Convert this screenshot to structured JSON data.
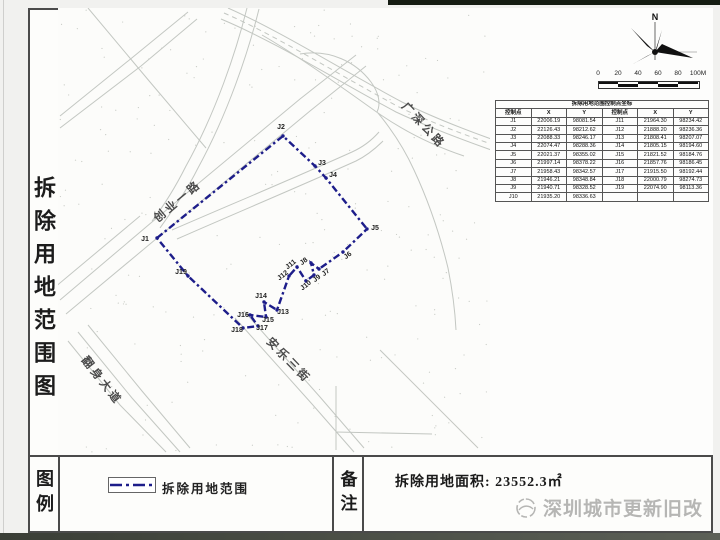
{
  "page": {
    "title_vertical": "拆除用地范围图"
  },
  "compass": {
    "label": "N"
  },
  "scale_bar": {
    "labels": [
      "0",
      "20",
      "40",
      "60",
      "80",
      "100M"
    ]
  },
  "coordinate_table": {
    "title": "拆除用地范围控制点坐标",
    "headers": [
      "控制点",
      "X",
      "Y",
      "控制点",
      "X",
      "Y"
    ],
    "left_rows": [
      [
        "J1",
        "22006.19",
        "98081.54"
      ],
      [
        "J2",
        "22126.43",
        "98212.62"
      ],
      [
        "J3",
        "22088.33",
        "98246.17"
      ],
      [
        "J4",
        "22074.47",
        "98288.36"
      ],
      [
        "J5",
        "22021.37",
        "98355.02"
      ],
      [
        "J6",
        "21997.14",
        "98378.22"
      ],
      [
        "J7",
        "21958.43",
        "98342.57"
      ],
      [
        "J8",
        "21946.21",
        "98348.84"
      ],
      [
        "J9",
        "21940.71",
        "98328.52"
      ],
      [
        "J10",
        "21935.20",
        "98336.63"
      ]
    ],
    "right_rows": [
      [
        "J11",
        "21964.30",
        "98234.42"
      ],
      [
        "J12",
        "21888.20",
        "98236.36"
      ],
      [
        "J13",
        "21808.41",
        "98207.07"
      ],
      [
        "J14",
        "21805.15",
        "98194.60"
      ],
      [
        "J15",
        "21821.52",
        "98184.76"
      ],
      [
        "J16",
        "21857.76",
        "98186.45"
      ],
      [
        "J17",
        "21915.50",
        "98192.44"
      ],
      [
        "J18",
        "22000.79",
        "98274.73"
      ],
      [
        "J19",
        "22074.90",
        "98113.36"
      ]
    ]
  },
  "map": {
    "boundary_color": "#1d1d8a",
    "road_labels": [
      {
        "text": "创业一路",
        "x": 180,
        "y": 204,
        "rot": -40
      },
      {
        "text": "广深公路",
        "x": 421,
        "y": 128,
        "rot": 47
      },
      {
        "text": "安乐三街",
        "x": 286,
        "y": 363,
        "rot": 46
      },
      {
        "text": "翻身大道",
        "x": 99,
        "y": 383,
        "rot": 52
      }
    ],
    "points": [
      {
        "id": "J1",
        "x": 157,
        "y": 238,
        "lx": 145,
        "ly": 241
      },
      {
        "id": "J2",
        "x": 283,
        "y": 136,
        "lx": 281,
        "ly": 129
      },
      {
        "id": "J3",
        "x": 315,
        "y": 166,
        "lx": 322,
        "ly": 165
      },
      {
        "id": "J4",
        "x": 326,
        "y": 178,
        "lx": 333,
        "ly": 177
      },
      {
        "id": "J5",
        "x": 367,
        "y": 229,
        "lx": 375,
        "ly": 230
      },
      {
        "id": "J6",
        "x": 343,
        "y": 252,
        "lx": 349,
        "ly": 257,
        "rot": -38
      },
      {
        "id": "J7",
        "x": 319,
        "y": 269,
        "lx": 327,
        "ly": 274,
        "rot": -38
      },
      {
        "id": "J8",
        "x": 311,
        "y": 263,
        "lx": 305,
        "ly": 263,
        "rot": -38
      },
      {
        "id": "J9",
        "x": 314,
        "y": 275,
        "lx": 318,
        "ly": 280,
        "rot": -38
      },
      {
        "id": "J10",
        "x": 306,
        "y": 281,
        "lx": 307,
        "ly": 287,
        "rot": -38
      },
      {
        "id": "J11",
        "x": 297,
        "y": 267,
        "lx": 292,
        "ly": 266,
        "rot": -38
      },
      {
        "id": "J12",
        "x": 289,
        "y": 276,
        "lx": 284,
        "ly": 277,
        "rot": -38
      },
      {
        "id": "J13",
        "x": 277,
        "y": 310,
        "lx": 283,
        "ly": 314
      },
      {
        "id": "J14",
        "x": 264,
        "y": 302,
        "lx": 261,
        "ly": 298
      },
      {
        "id": "J15",
        "x": 266,
        "y": 317,
        "lx": 268,
        "ly": 322
      },
      {
        "id": "J16",
        "x": 250,
        "y": 315,
        "lx": 243,
        "ly": 317
      },
      {
        "id": "J17",
        "x": 258,
        "y": 326,
        "lx": 262,
        "ly": 330
      },
      {
        "id": "J18",
        "x": 243,
        "y": 328,
        "lx": 237,
        "ly": 332
      },
      {
        "id": "J19",
        "x": 188,
        "y": 276,
        "lx": 181,
        "ly": 274
      }
    ]
  },
  "legend": {
    "label_vertical": "图例",
    "item_label": "拆除用地范围"
  },
  "notes": {
    "label_vertical": "备注",
    "area_text": "拆除用地面积: 23552.3㎡"
  },
  "watermark": {
    "text": "深圳城市更新旧改"
  }
}
